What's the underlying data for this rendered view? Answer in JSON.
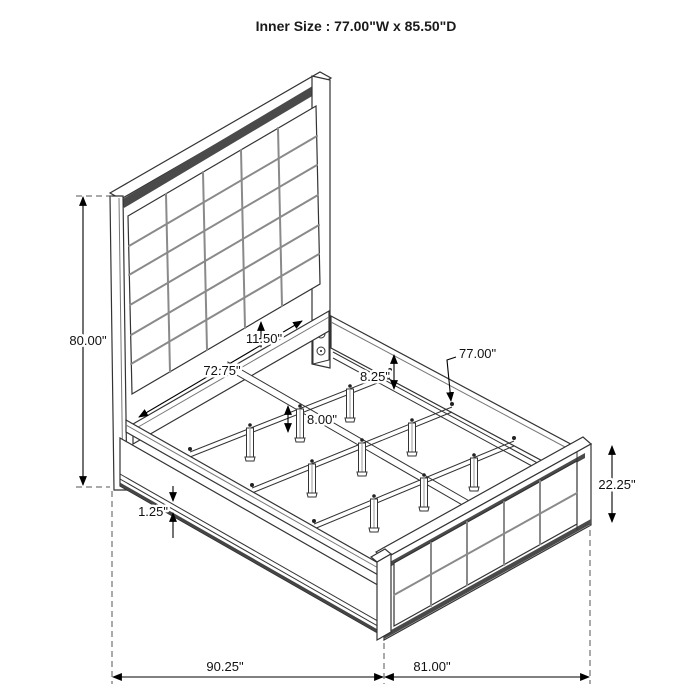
{
  "title": "Inner Size : 77.00\"W x 85.50\"D",
  "dims": {
    "headboard_height": "80.00\"",
    "headboard_span": "72.75\"",
    "panel_gap": "11.50\"",
    "rail_height": "8.25\"",
    "inner_width": "77.00\"",
    "leg_height": "8.00\"",
    "footboard_height": "22.25\"",
    "rail_lip": "1.25\"",
    "overall_depth": "90.25\"",
    "overall_width": "81.00\""
  }
}
